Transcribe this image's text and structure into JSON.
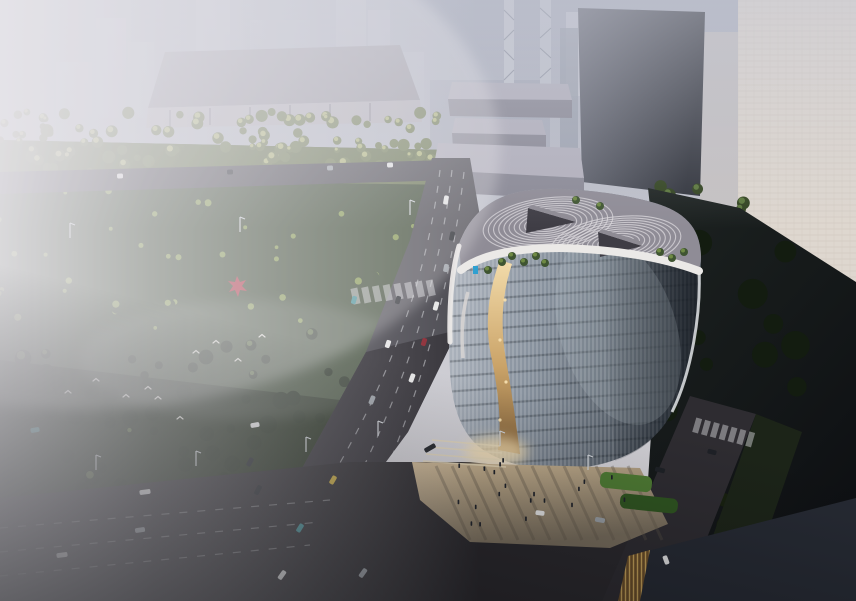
{
  "scene": {
    "description": "Hazy aerial rendering of a rounded-square glass office building with a golden atrium canyon, rooftop louver swirls, a tree-filled park, wide boulevards with traffic, and a fog-washed city skyline",
    "colors": {
      "sky_top": "#a9aebc",
      "sky_mid": "#c6c7cf",
      "sky_low": "#d8d5d8",
      "haze": "#e6e4e9",
      "distant_tower": "#b9bcc8",
      "hazy_tower_warm": "#ded7cf",
      "dark_tower_light": "#6a6d78",
      "dark_tower_deep": "#30333b",
      "hall_roof": "#9a98a2",
      "hall_wall": "#b5b2ba",
      "podium_roof": "#b3b1bd",
      "podium_wall": "#8b8a96",
      "podium_shade": "#4e4e58",
      "park_light": "#6f7b52",
      "park_mid": "#3c4a34",
      "park_dark": "#232d1e",
      "tree_highlight": "#b9bf7d",
      "tree_highlight_mid": "#8ba050",
      "shadow_tree": "#131c10",
      "lit_tree": "#5f7c3e",
      "road": "#4a4950",
      "road_dark": "#2e2c31",
      "intersection": "#2b292d",
      "lane_mark": "#d6d7da",
      "glass_light": "#b7bdc6",
      "glass_mid": "#87919d",
      "glass_dark": "#3f4750",
      "parapet": "#ebe9e7",
      "roof_deck": "#8f8c96",
      "roof_rib": "#dcd9dd",
      "roof_core": "#3f3d45",
      "atrium_gold_light": "#f3dcab",
      "atrium_gold_mid": "#caa368",
      "atrium_gold_deep": "#7e5f3a",
      "plaza_light": "#cdb794",
      "plaza_shadow": "#7a6f5e",
      "hedge_green": "#4e7a33",
      "shadow_zone": "#0e1013",
      "corner_roof": "#262a33",
      "gold_slats": "#c9a45a",
      "gold_slats_dark": "#6b4e28",
      "car_white": "#e8e8e8",
      "car_gray": "#9aa0a6",
      "car_dark": "#1e2126",
      "car_red": "#8a2630",
      "car_teal": "#3f8f96",
      "car_yellow": "#c8a93a",
      "logo_blue": "#2e9fd0",
      "bird_white": "#e8e6df",
      "sculpture_red": "#b03040",
      "lamp_light": "#cfd3d8",
      "glow_warm": "#f4ddae"
    }
  }
}
